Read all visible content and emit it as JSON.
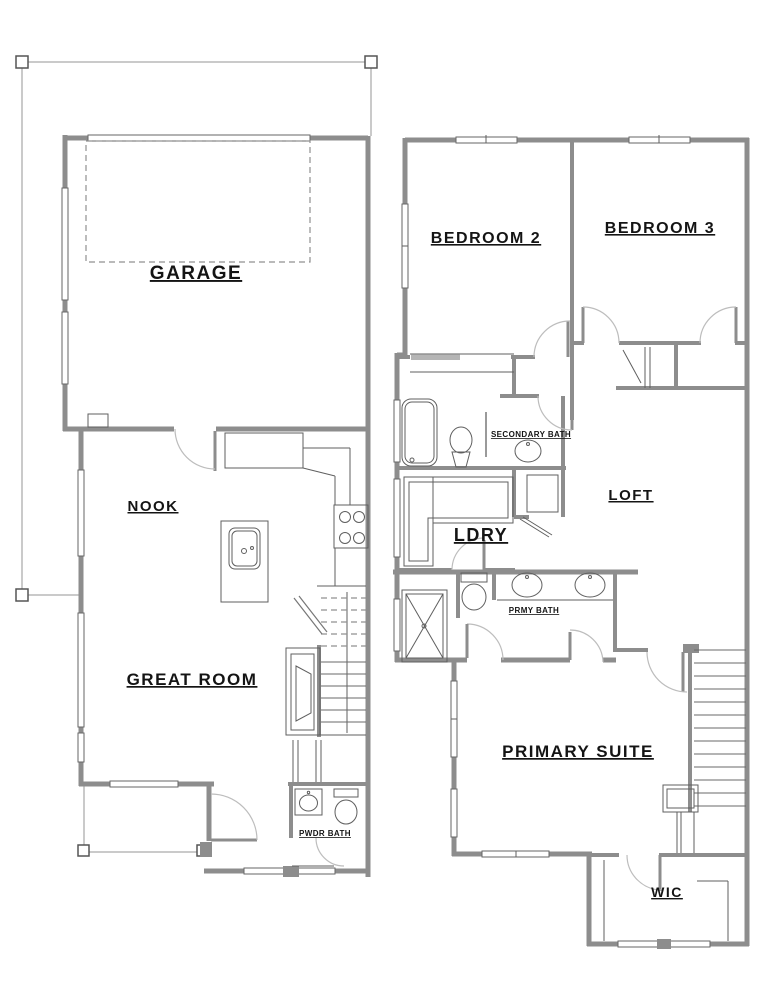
{
  "page": {
    "title": "Two-story residential floor plan",
    "background": "#ffffff"
  },
  "colors": {
    "wall": "#8d8d8d",
    "detail_line": "#5f5f5f",
    "door_arc": "#bdbdbd",
    "dashed_line": "#909090",
    "roof_line": "#b9b9b9",
    "text": "#141414"
  },
  "floors": [
    {
      "name": "first-floor",
      "rooms": [
        "GARAGE",
        "NOOK",
        "GREAT ROOM",
        "PWDR BATH"
      ]
    },
    {
      "name": "second-floor",
      "rooms": [
        "BEDROOM 2",
        "BEDROOM 3",
        "SECONDARY BATH",
        "LOFT",
        "LDRY",
        "PRMY BATH",
        "PRIMARY SUITE",
        "WIC"
      ]
    }
  ],
  "labels": {
    "garage": "GARAGE",
    "nook": "NOOK",
    "great_room": "GREAT ROOM",
    "pwdr_bath": "PWDR BATH",
    "bedroom2": "BEDROOM 2",
    "bedroom3": "BEDROOM 3",
    "secondary_bath": "SECONDARY BATH",
    "loft": "LOFT",
    "ldry": "LDRY",
    "prmy_bath": "PRMY BATH",
    "primary_suite": "PRIMARY SUITE",
    "wic": "WIC"
  }
}
